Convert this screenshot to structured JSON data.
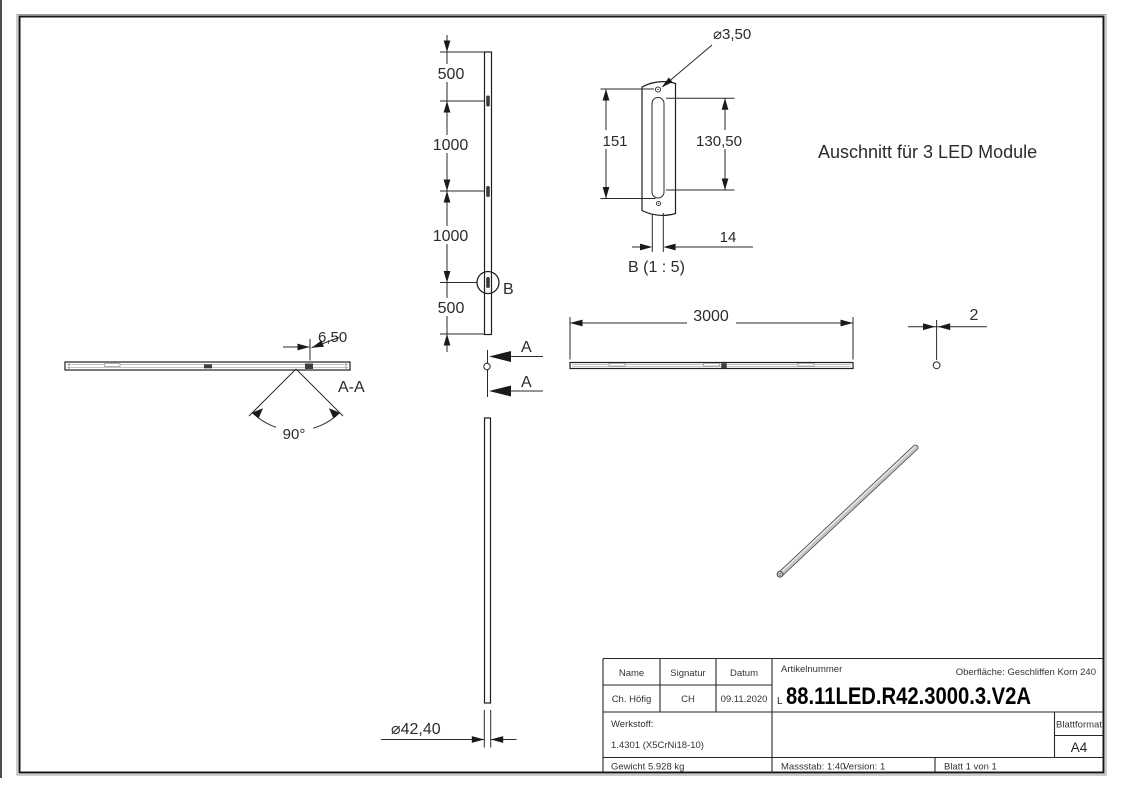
{
  "drawing": {
    "note": "Auschnitt für 3 LED Module",
    "front_view": {
      "dim_top": "500",
      "dim_mid1": "1000",
      "dim_mid2": "1000",
      "dim_bottom": "500",
      "detail_marker": "B",
      "section_label_top": "A",
      "section_label_bottom": "A"
    },
    "detail_b": {
      "hole_diameter": "⌀3,50",
      "overall_height": "151",
      "slot_height": "130,50",
      "slot_width": "14",
      "caption": "B (1 : 5)"
    },
    "section_aa": {
      "caption": "A-A",
      "offset": "6,50",
      "angle": "90°"
    },
    "top_view": {
      "length": "3000",
      "wall_thickness": "2"
    },
    "side_view": {
      "diameter": "⌀42,40"
    },
    "title_block": {
      "name_label": "Name",
      "signatur_label": "Signatur",
      "datum_label": "Datum",
      "name": "Ch. Höfig",
      "signatur": "CH",
      "datum": "09.11.2020",
      "artikelnummer_label": "Artikelnummer",
      "artikelnummer_prefix": "L",
      "artikelnummer": "88.11LED.R42.3000.3.V2A",
      "oberflaeche": "Oberfläche:  Geschliffen Korn 240",
      "werkstoff_label": "Werkstoff:",
      "werkstoff": "1.4301 (X5CrNi18-10)",
      "blattformat_label": "Blattformat",
      "blattformat": "A4",
      "gewicht": "Gewicht 5.928 kg",
      "massstab": "Massstab: 1:40",
      "version": "Version: 1",
      "blatt": "Blatt 1 von 1"
    }
  }
}
